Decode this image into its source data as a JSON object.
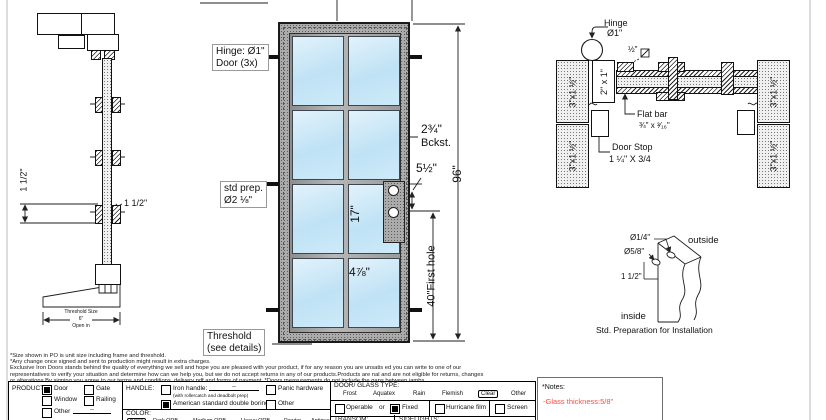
{
  "colors": {
    "glass": "#c6e6f7",
    "note_red": "#ff4a42",
    "frame_gray": "#ababab"
  },
  "section_view": {
    "dim_side": "1 1/2\"",
    "dim_front": "1 1/2\"",
    "threshold_title": "Threshold Size",
    "threshold_size": "6\"",
    "threshold_dir": "Open in"
  },
  "elevation": {
    "hinge_label_1": "Hinge: Ø1\"",
    "hinge_label_2": "Door (3x)",
    "std_prep_1": "std prep.",
    "std_prep_2": "Ø2 ⅛\"",
    "threshold_1": "Threshold",
    "threshold_2": "(see details)",
    "dim_backset": "2¾\"",
    "dim_backset_label": "Bckst.",
    "dim_five_half": "5½\"",
    "dim_seventeen": "17\"",
    "dim_four78": "4⅞\"",
    "dim_height": "96\"",
    "dim_first_hole": "40\"First hole"
  },
  "plan": {
    "hinge_1": "Hinge",
    "hinge_2": "Ø1\"",
    "half_square": "½\"",
    "stile": "2\" x 1\"",
    "jamb": "3\"x1 ½\"",
    "flat_bar_1": "Flat bar",
    "flat_bar_2": "¾\" x ³⁄₁₆\"",
    "door_stop_1": "Door Stop",
    "door_stop_2": "1 ¼\" X 3/4"
  },
  "detail": {
    "dia_quarter": "Ø1/4\"",
    "dia_58": "Ø5/8\"",
    "dim_1half": "1 1/2\"",
    "outside": "outside",
    "inside": "inside",
    "title": "Std. Preparation for Installation"
  },
  "notes_lines": [
    "*Size shown in PO is unit size including frame and threshold.",
    "*Any change once signed and sent to production might result in extra charges.",
    "Exclusive Iron Doors stands behind the quality of everything we sell and hope you are pleased with your product, if for any reason you are unsatis ed you can write to one of our",
    "representatives to verify your situation and determine how can we help you, but we do not accept returns in any of our products.Products are  nal and are not eligible for returns, changes",
    "or alterations.By signing you agree to our terms and conditions, delivery pdf and forms of payment. *Doors measurements do not include the gaps between jambs"
  ],
  "form": {
    "product": {
      "label": "PRODUCT:",
      "door": "Door",
      "gate": "Gate",
      "window": "Window",
      "railing": "Railing",
      "other": "Other",
      "other_value": "--"
    },
    "handle": {
      "label": "HANDLE:",
      "iron": "Iron handle:",
      "iron_value": "--",
      "iron_sub": "(with rollercatch and deadbolt prep)",
      "american": "American standard double boring",
      "panic": "Panic hardware",
      "other": "Other"
    },
    "color": {
      "label": "COLOR:",
      "options": [
        "Black",
        "Dark ORB",
        "Medium ORB",
        "Heavy ORB",
        "Pewter",
        "Antique gold"
      ],
      "selected": "Black"
    },
    "glass": {
      "label": "DOOR/ GLASS TYPE:",
      "options": [
        "Frost",
        "Aquatex",
        "Rain",
        "Flemish",
        "Clear",
        "Other"
      ],
      "selected": "Clear"
    },
    "mode": {
      "operable": "Operable",
      "or": "or",
      "fixed": "Fixed",
      "hurricane": "Hurricane film",
      "screen": "Screen"
    },
    "transom": "TRANSOM:",
    "sidelights": "SIDELIGHTS:",
    "notes_title": "*Notes:",
    "notes_value": "-Glass thickness:5/8\""
  }
}
